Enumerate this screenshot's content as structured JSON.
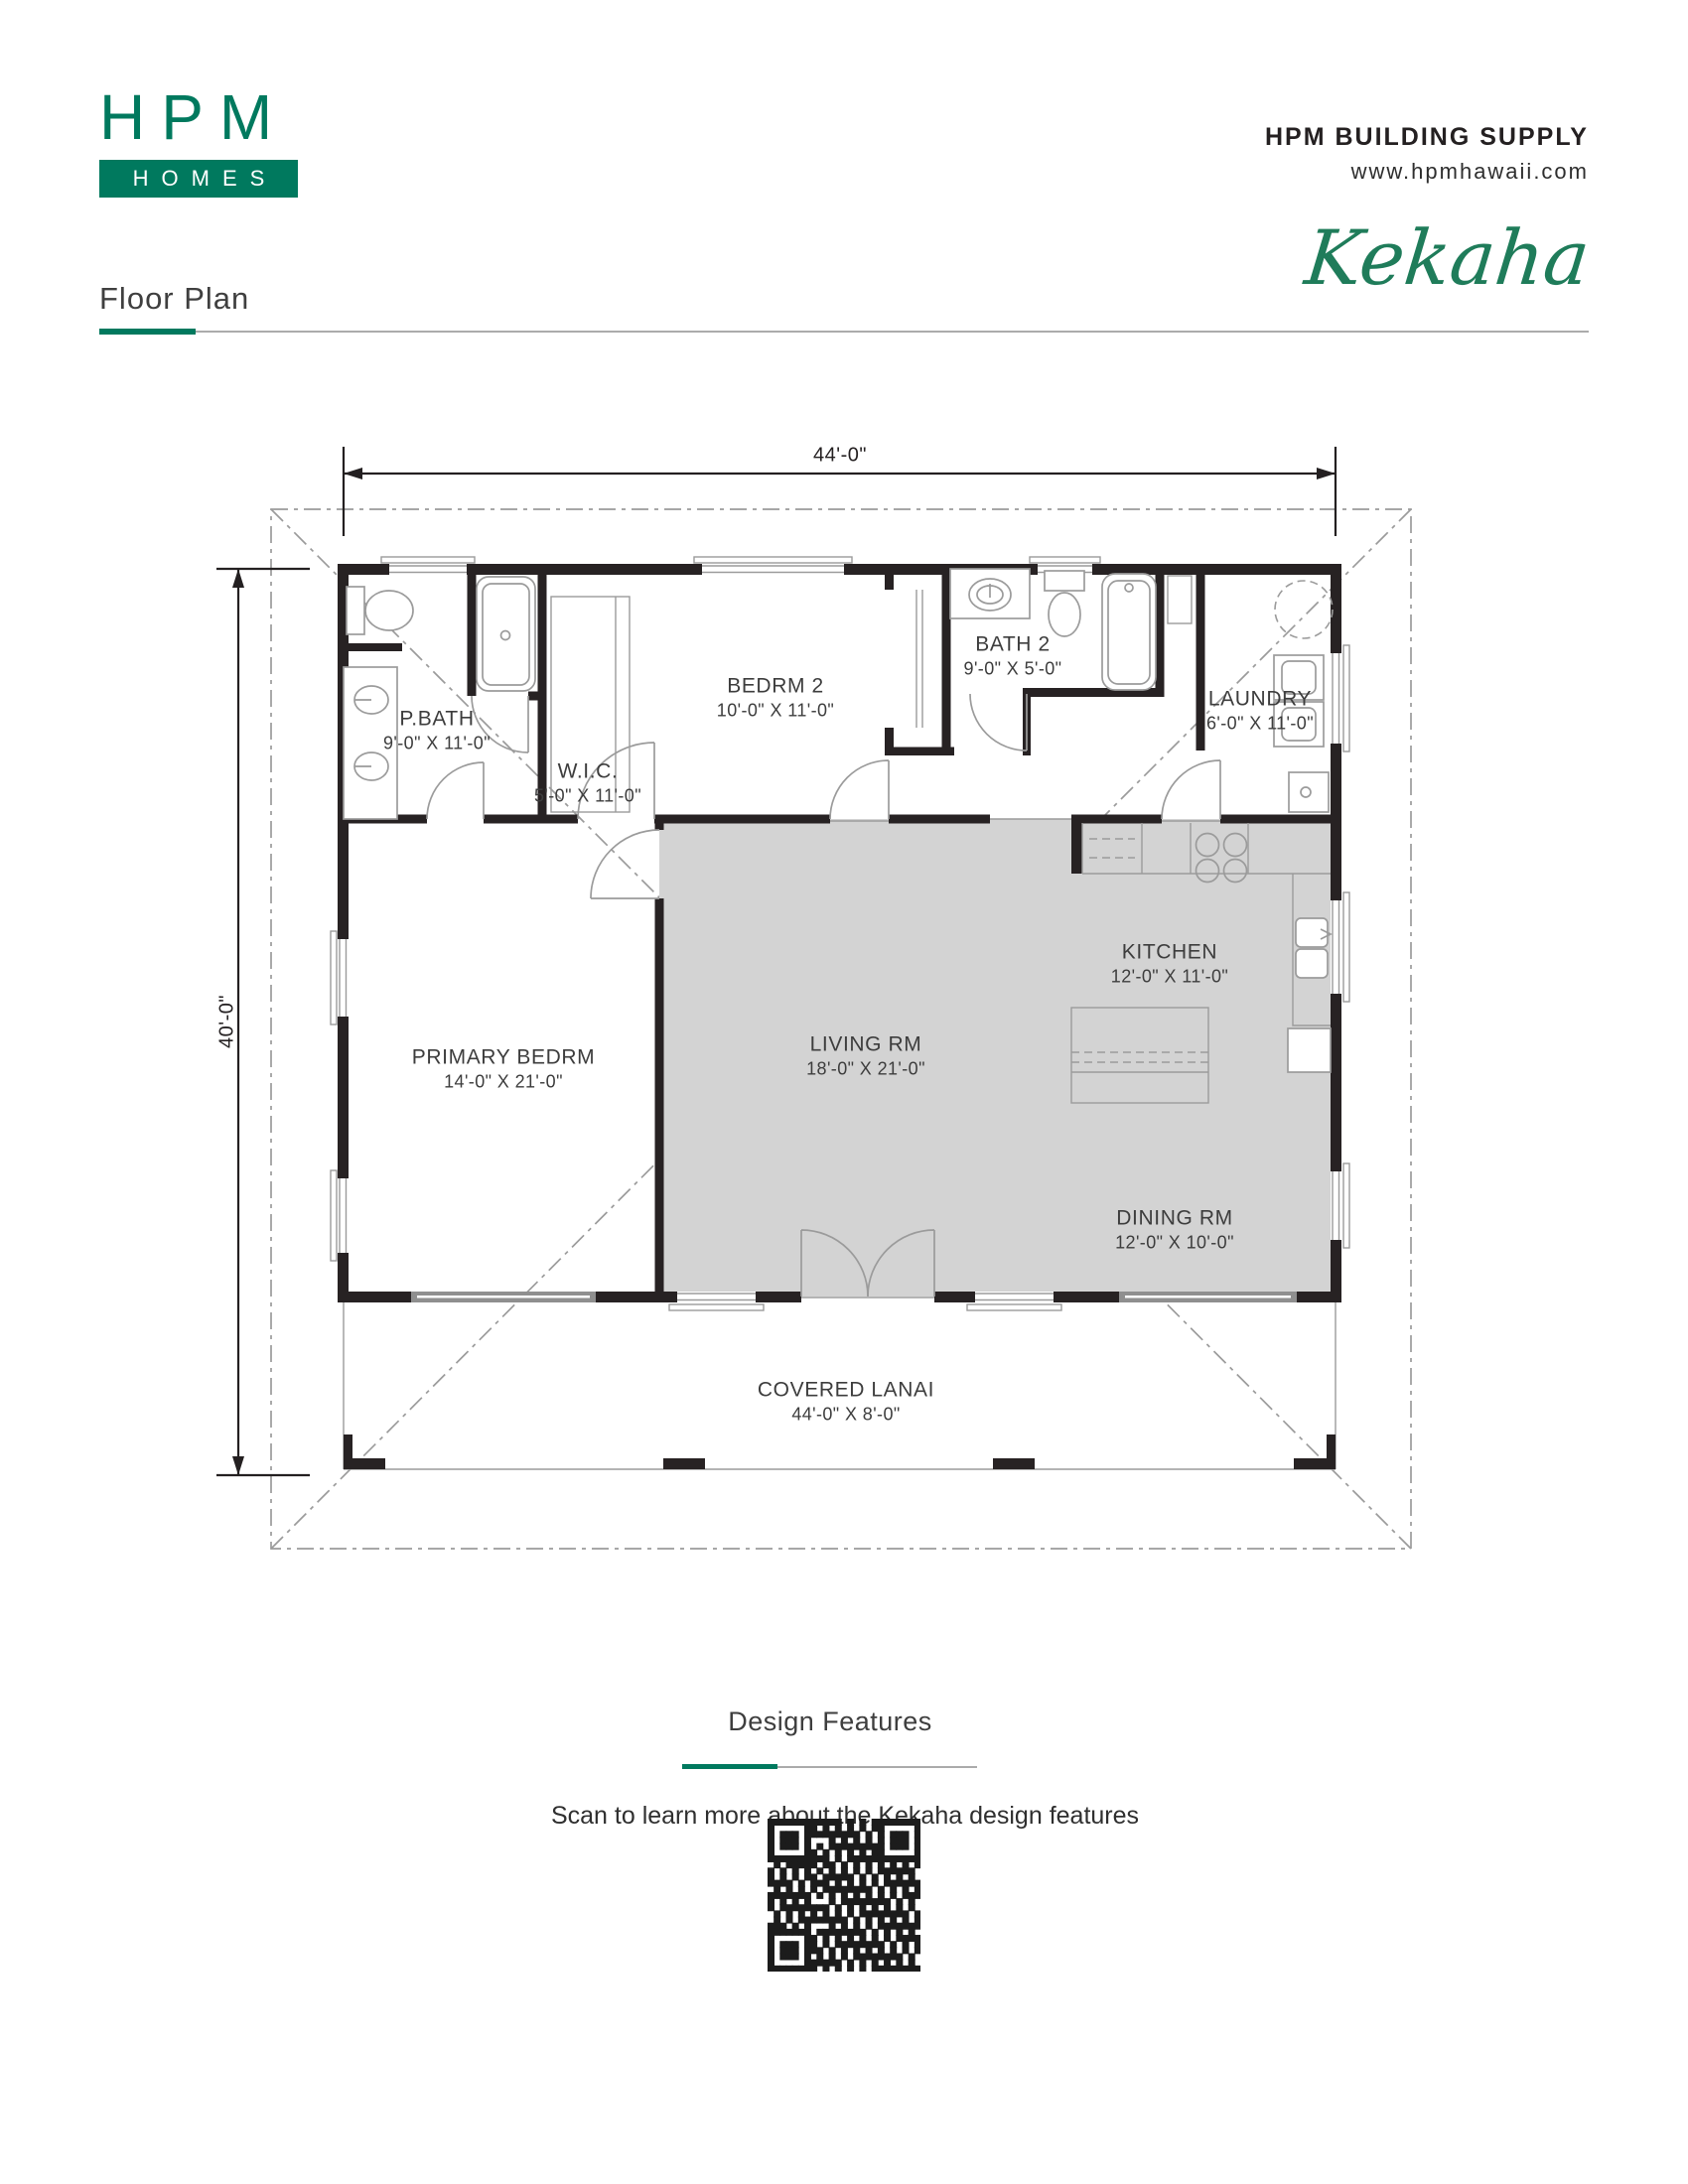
{
  "header": {
    "logo_top": "HPM",
    "logo_bottom": "HOMES",
    "company": "HPM BUILDING SUPPLY",
    "website": "www.hpmhawaii.com",
    "model_name": "Kekaha",
    "page_label": "Floor Plan"
  },
  "plan": {
    "overall_width": "44'-0\"",
    "overall_depth": "40'-0\"",
    "rooms": [
      {
        "name": "P.BATH",
        "dims": "9'-0\" X 11'-0\""
      },
      {
        "name": "W.I.C.",
        "dims": "5'-0\" X 11'-0\""
      },
      {
        "name": "BEDRM 2",
        "dims": "10'-0\" X 11'-0\""
      },
      {
        "name": "BATH 2",
        "dims": "9'-0\" X 5'-0\""
      },
      {
        "name": "LAUNDRY",
        "dims": "6'-0\" X 11'-0\""
      },
      {
        "name": "PRIMARY BEDRM",
        "dims": "14'-0\" X 21'-0\""
      },
      {
        "name": "LIVING RM",
        "dims": "18'-0\" X 21'-0\""
      },
      {
        "name": "KITCHEN",
        "dims": "12'-0\" X 11'-0\""
      },
      {
        "name": "DINING RM",
        "dims": "12'-0\" X 10'-0\""
      },
      {
        "name": "COVERED LANAI",
        "dims": "44'-0\" X 8'-0\""
      }
    ]
  },
  "footer": {
    "section_title": "Design Features",
    "scan_text": "Scan to learn more about the Kekaha design features",
    "qr_label": "qr-code"
  },
  "colors": {
    "brand_green": "#00795E",
    "script_green": "#1F7C5A",
    "wall": "#272223",
    "line_gray": "#9B9B9B",
    "floor_shade": "#D3D3D3",
    "text_dark": "#3D3D3D"
  }
}
